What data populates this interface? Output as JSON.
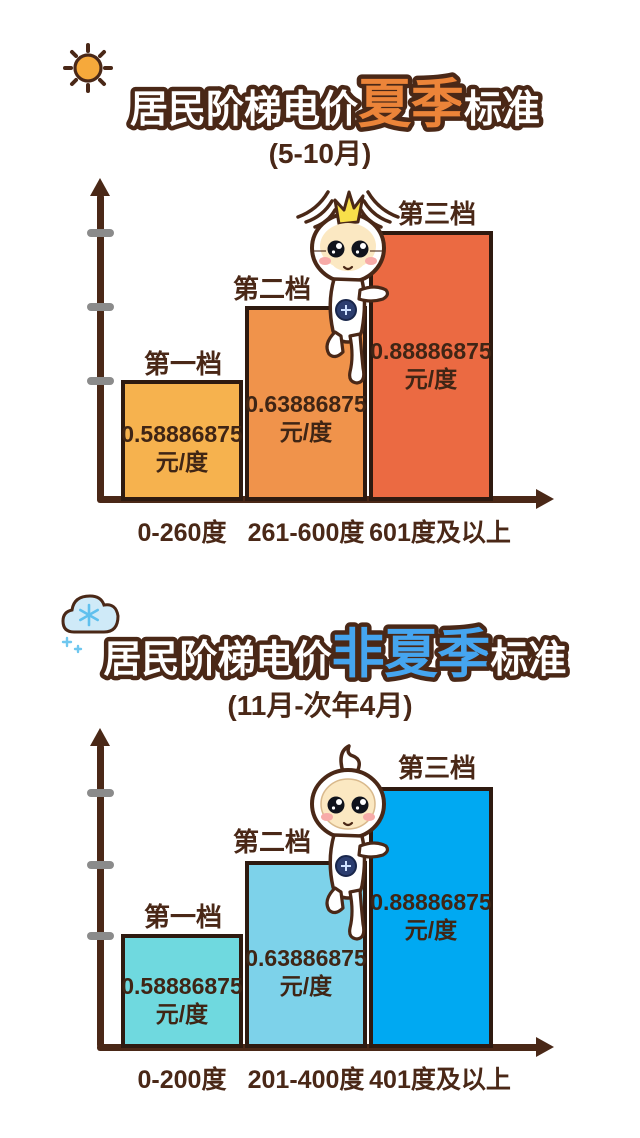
{
  "summer": {
    "title_prefix": "居民阶梯电价",
    "title_accent": "夏季",
    "title_suffix": "标准",
    "subtitle": "(5-10月)",
    "accent_color": "#EC8439",
    "tiers": [
      {
        "label": "第一档",
        "price": "0.58886875",
        "unit": "元/度",
        "range": "0-260度",
        "color": "#F6B24E"
      },
      {
        "label": "第二档",
        "price": "0.63886875",
        "unit": "元/度",
        "range": "261-600度",
        "color": "#F0934B"
      },
      {
        "label": "第三档",
        "price": "0.88886875",
        "unit": "元/度",
        "range": "601度及以上",
        "color": "#EB6A42"
      }
    ]
  },
  "winter": {
    "title_prefix": "居民阶梯电价",
    "title_accent": "非夏季",
    "title_suffix": "标准",
    "subtitle": "(11月-次年4月)",
    "accent_color": "#45A5EF",
    "tiers": [
      {
        "label": "第一档",
        "price": "0.58886875",
        "unit": "元/度",
        "range": "0-200度",
        "color": "#6FD9DF"
      },
      {
        "label": "第二档",
        "price": "0.63886875",
        "unit": "元/度",
        "range": "201-400度",
        "color": "#7DD2EA"
      },
      {
        "label": "第三档",
        "price": "0.88886875",
        "unit": "元/度",
        "range": "401度及以上",
        "color": "#00A9F2"
      }
    ]
  },
  "colors": {
    "axis": "#4A2817",
    "bar_border": "#2E1A10",
    "tick": "#8B8B8B",
    "text": "#4A2817"
  },
  "chart_data": [
    {
      "type": "bar",
      "title": "居民阶梯电价夏季标准 (5-10月)",
      "categories": [
        "0-260度",
        "261-600度",
        "601度及以上"
      ],
      "series": [
        {
          "name": "电价(元/度)",
          "values": [
            0.58886875,
            0.63886875,
            0.88886875
          ]
        }
      ],
      "tier_labels": [
        "第一档",
        "第二档",
        "第三档"
      ],
      "unit": "元/度",
      "xlabel": "用电量(度)",
      "ylabel": "",
      "grid": false,
      "legend_position": "none",
      "colors": [
        "#F6B24E",
        "#F0934B",
        "#EB6A42"
      ]
    },
    {
      "type": "bar",
      "title": "居民阶梯电价非夏季标准 (11月-次年4月)",
      "categories": [
        "0-200度",
        "201-400度",
        "401度及以上"
      ],
      "series": [
        {
          "name": "电价(元/度)",
          "values": [
            0.58886875,
            0.63886875,
            0.88886875
          ]
        }
      ],
      "tier_labels": [
        "第一档",
        "第二档",
        "第三档"
      ],
      "unit": "元/度",
      "xlabel": "用电量(度)",
      "ylabel": "",
      "grid": false,
      "legend_position": "none",
      "colors": [
        "#6FD9DF",
        "#7DD2EA",
        "#00A9F2"
      ]
    }
  ]
}
